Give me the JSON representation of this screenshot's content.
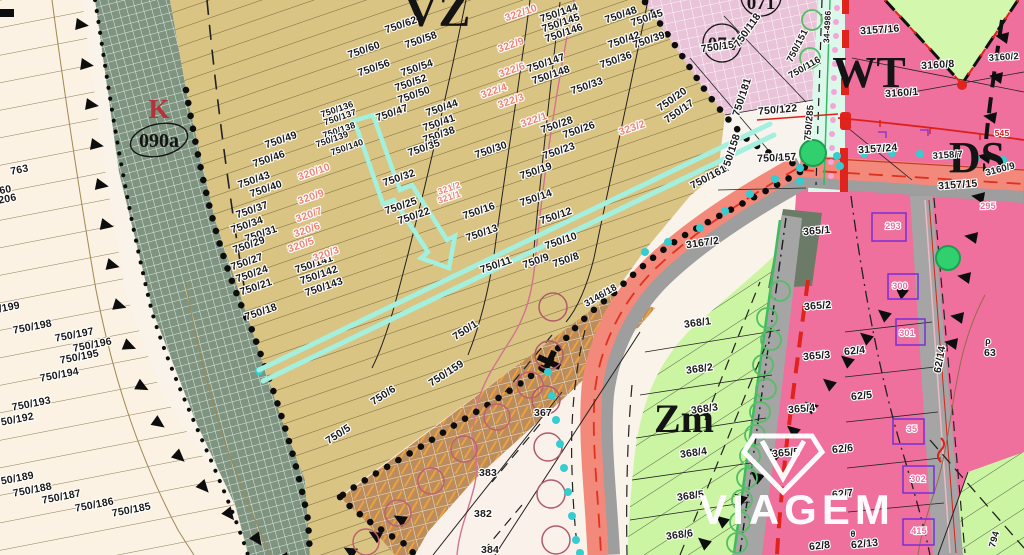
{
  "watermark": {
    "brand": "VIAGEM"
  },
  "zone_labels": {
    "vz": {
      "text": "VZ"
    },
    "k": {
      "text": "K"
    },
    "k_code": {
      "text": "090a"
    },
    "z074": {
      "text": "074"
    },
    "z071": {
      "text": "071"
    },
    "wt": {
      "text": "WT"
    },
    "ds": {
      "text": "DS"
    },
    "zm": {
      "text": "Zm"
    }
  },
  "colors": {
    "route_highlight": "#a4f0de",
    "road_salmon": "#f2897b",
    "road_gray": "#a5a5a5",
    "zone_tan": "#d9c483",
    "zone_green_band": "#7e9480",
    "zone_pink_grid": "#e9c3d8",
    "zone_pink": "#ef6f9d",
    "zone_zm_green": "#ccf5a3",
    "zone_cream": "#fbf2e3",
    "boundary_black": "#111111",
    "accent_red": "#dd2019",
    "teal_dots": "#35cdd0",
    "parcel_pink_text": "#ee8374",
    "building_pink_text": "#f0699c"
  },
  "parcel_labels": [
    {
      "t": "750/62",
      "x": 402,
      "y": 28,
      "r": -19
    },
    {
      "t": "750/60",
      "x": 365,
      "y": 53,
      "r": -19
    },
    {
      "t": "750/58",
      "x": 422,
      "y": 43,
      "r": -19
    },
    {
      "t": "750/56",
      "x": 375,
      "y": 71,
      "r": -19
    },
    {
      "t": "750/54",
      "x": 418,
      "y": 71,
      "r": -19
    },
    {
      "t": "750/52",
      "x": 412,
      "y": 86,
      "r": -19
    },
    {
      "t": "750/50",
      "x": 415,
      "y": 98,
      "r": -19
    },
    {
      "t": "750/47",
      "x": 393,
      "y": 116,
      "r": -19
    },
    {
      "t": "750/44",
      "x": 443,
      "y": 111,
      "r": -19
    },
    {
      "t": "750/41",
      "x": 440,
      "y": 126,
      "r": -19
    },
    {
      "t": "750/38",
      "x": 440,
      "y": 138,
      "r": -19
    },
    {
      "t": "750/35",
      "x": 425,
      "y": 151,
      "r": -19
    },
    {
      "t": "750/32",
      "x": 400,
      "y": 181,
      "r": -19
    },
    {
      "t": "750/30",
      "x": 492,
      "y": 153,
      "r": -19
    },
    {
      "t": "750/25",
      "x": 402,
      "y": 209,
      "r": -19
    },
    {
      "t": "750/22",
      "x": 415,
      "y": 219,
      "r": -19
    },
    {
      "t": "750/16",
      "x": 480,
      "y": 214,
      "r": -19
    },
    {
      "t": "750/13",
      "x": 483,
      "y": 236,
      "r": -19
    },
    {
      "t": "750/11",
      "x": 497,
      "y": 268,
      "r": -19
    },
    {
      "t": "750/19",
      "x": 537,
      "y": 174,
      "r": -19
    },
    {
      "t": "750/14",
      "x": 537,
      "y": 201,
      "r": -19
    },
    {
      "t": "750/12",
      "x": 557,
      "y": 219,
      "r": -19
    },
    {
      "t": "750/10",
      "x": 562,
      "y": 244,
      "r": -19
    },
    {
      "t": "750/9",
      "x": 537,
      "y": 264,
      "r": -19
    },
    {
      "t": "750/8",
      "x": 567,
      "y": 263,
      "r": -19
    },
    {
      "t": "750/23",
      "x": 560,
      "y": 154,
      "r": -19
    },
    {
      "t": "750/26",
      "x": 580,
      "y": 133,
      "r": -19
    },
    {
      "t": "750/28",
      "x": 558,
      "y": 128,
      "r": -19
    },
    {
      "t": "750/33",
      "x": 588,
      "y": 89,
      "r": -19
    },
    {
      "t": "750/36",
      "x": 617,
      "y": 63,
      "r": -19
    },
    {
      "t": "750/42",
      "x": 625,
      "y": 43,
      "r": -19
    },
    {
      "t": "750/48",
      "x": 622,
      "y": 18,
      "r": -19
    },
    {
      "t": "750/45",
      "x": 648,
      "y": 21,
      "r": -19
    },
    {
      "t": "750/39",
      "x": 650,
      "y": 43,
      "r": -19
    },
    {
      "t": "750/144",
      "x": 560,
      "y": 16,
      "r": -19
    },
    {
      "t": "750/145",
      "x": 562,
      "y": 26,
      "r": -19
    },
    {
      "t": "750/146",
      "x": 565,
      "y": 36,
      "r": -19
    },
    {
      "t": "750/147",
      "x": 547,
      "y": 66,
      "r": -19
    },
    {
      "t": "750/148",
      "x": 552,
      "y": 78,
      "r": -19
    },
    {
      "t": "750/20",
      "x": 674,
      "y": 102,
      "r": -35
    },
    {
      "t": "750/17",
      "x": 681,
      "y": 114,
      "r": -35
    },
    {
      "t": "750/136",
      "x": 338,
      "y": 112,
      "r": -19,
      "s": 9
    },
    {
      "t": "750/137",
      "x": 341,
      "y": 120,
      "r": -19,
      "s": 9
    },
    {
      "t": "750/138",
      "x": 340,
      "y": 133,
      "r": -19,
      "s": 9
    },
    {
      "t": "750/139",
      "x": 333,
      "y": 142,
      "r": -19,
      "s": 9
    },
    {
      "t": "750/140",
      "x": 348,
      "y": 150,
      "r": -19,
      "s": 9
    },
    {
      "t": "750/49",
      "x": 282,
      "y": 143,
      "r": -19
    },
    {
      "t": "750/46",
      "x": 270,
      "y": 162,
      "r": -19
    },
    {
      "t": "750/43",
      "x": 255,
      "y": 183,
      "r": -19
    },
    {
      "t": "750/40",
      "x": 267,
      "y": 192,
      "r": -19
    },
    {
      "t": "750/37",
      "x": 253,
      "y": 213,
      "r": -19
    },
    {
      "t": "750/34",
      "x": 248,
      "y": 228,
      "r": -19
    },
    {
      "t": "750/31",
      "x": 262,
      "y": 237,
      "r": -19
    },
    {
      "t": "750/29",
      "x": 250,
      "y": 248,
      "r": -19
    },
    {
      "t": "750/27",
      "x": 248,
      "y": 265,
      "r": -19
    },
    {
      "t": "750/24",
      "x": 253,
      "y": 277,
      "r": -19
    },
    {
      "t": "750/21",
      "x": 257,
      "y": 290,
      "r": -19
    },
    {
      "t": "750/18",
      "x": 262,
      "y": 315,
      "r": -19
    },
    {
      "t": "750/141",
      "x": 315,
      "y": 267,
      "r": -19
    },
    {
      "t": "750/142",
      "x": 320,
      "y": 278,
      "r": -19
    },
    {
      "t": "750/143",
      "x": 325,
      "y": 290,
      "r": -19
    },
    {
      "t": "322/10",
      "x": 522,
      "y": 16,
      "r": -19,
      "c": "pink"
    },
    {
      "t": "322/9",
      "x": 512,
      "y": 48,
      "r": -19,
      "c": "pink"
    },
    {
      "t": "322/6",
      "x": 513,
      "y": 73,
      "r": -19,
      "c": "pink"
    },
    {
      "t": "322/4",
      "x": 495,
      "y": 94,
      "r": -19,
      "c": "pink"
    },
    {
      "t": "322/3",
      "x": 512,
      "y": 104,
      "r": -19,
      "c": "pink"
    },
    {
      "t": "322/1",
      "x": 535,
      "y": 123,
      "r": -19,
      "c": "pink"
    },
    {
      "t": "323/2",
      "x": 633,
      "y": 131,
      "r": -19,
      "c": "pink"
    },
    {
      "t": "321/2",
      "x": 450,
      "y": 191,
      "r": -19,
      "c": "pink",
      "s": 9
    },
    {
      "t": "321/1",
      "x": 450,
      "y": 200,
      "r": -19,
      "c": "pink",
      "s": 9
    },
    {
      "t": "320/10",
      "x": 315,
      "y": 175,
      "r": -19,
      "c": "pink"
    },
    {
      "t": "320/9",
      "x": 312,
      "y": 200,
      "r": -19,
      "c": "pink"
    },
    {
      "t": "320/7",
      "x": 310,
      "y": 218,
      "r": -19,
      "c": "pink"
    },
    {
      "t": "320/6",
      "x": 308,
      "y": 233,
      "r": -19,
      "c": "pink"
    },
    {
      "t": "320/5",
      "x": 302,
      "y": 248,
      "r": -19,
      "c": "pink"
    },
    {
      "t": "320/3",
      "x": 327,
      "y": 257,
      "r": -19,
      "c": "pink"
    },
    {
      "t": "750/1",
      "x": 467,
      "y": 333,
      "r": -33
    },
    {
      "t": "750/159",
      "x": 448,
      "y": 376,
      "r": -33
    },
    {
      "t": "750/6",
      "x": 385,
      "y": 398,
      "r": -33
    },
    {
      "t": "750/5",
      "x": 340,
      "y": 437,
      "r": -33
    },
    {
      "t": "3167/2",
      "x": 703,
      "y": 246,
      "r": -8
    },
    {
      "t": "3146/18",
      "x": 602,
      "y": 298,
      "r": -30,
      "s": 9.5
    },
    {
      "t": "750/198",
      "x": 33,
      "y": 330,
      "r": -11
    },
    {
      "t": "750/197",
      "x": 75,
      "y": 338,
      "r": -11
    },
    {
      "t": "750/196",
      "x": 93,
      "y": 348,
      "r": -11
    },
    {
      "t": "750/195",
      "x": 80,
      "y": 360,
      "r": -11
    },
    {
      "t": "750/194",
      "x": 60,
      "y": 378,
      "r": -11
    },
    {
      "t": "750/193",
      "x": 32,
      "y": 407,
      "r": -11
    },
    {
      "t": "750/192",
      "x": 15,
      "y": 423,
      "r": -11
    },
    {
      "t": "750/189",
      "x": 15,
      "y": 482,
      "r": -11
    },
    {
      "t": "750/188",
      "x": 33,
      "y": 493,
      "r": -11
    },
    {
      "t": "750/187",
      "x": 62,
      "y": 500,
      "r": -11
    },
    {
      "t": "750/186",
      "x": 95,
      "y": 508,
      "r": -11
    },
    {
      "t": "750/185",
      "x": 132,
      "y": 513,
      "r": -11
    },
    {
      "t": "750/199",
      "x": 1,
      "y": 312,
      "r": -11
    },
    {
      "t": "763",
      "x": 20,
      "y": 173,
      "r": -11
    },
    {
      "t": "60",
      "x": 6,
      "y": 193,
      "r": -11
    },
    {
      "t": "206",
      "x": 8,
      "y": 202,
      "r": -11
    },
    {
      "t": "750/15",
      "x": 718,
      "y": 50,
      "r": -8
    },
    {
      "t": "750/118",
      "x": 750,
      "y": 32,
      "r": -55
    },
    {
      "t": "750/151",
      "x": 800,
      "y": 47,
      "r": -63,
      "s": 9.5
    },
    {
      "t": "750/116",
      "x": 806,
      "y": 70,
      "r": -30,
      "s": 9.5
    },
    {
      "t": "750/181",
      "x": 745,
      "y": 98,
      "r": -72
    },
    {
      "t": "750/122",
      "x": 778,
      "y": 113,
      "r": -5
    },
    {
      "t": "750/285",
      "x": 812,
      "y": 123,
      "r": -85,
      "s": 9.5
    },
    {
      "t": "750/157",
      "x": 777,
      "y": 161,
      "r": -3
    },
    {
      "t": "750/158",
      "x": 734,
      "y": 154,
      "r": -72
    },
    {
      "t": "750/161",
      "x": 710,
      "y": 180,
      "r": -28
    },
    {
      "t": "34-4986",
      "x": 830,
      "y": 27,
      "r": -87,
      "s": 8.5
    },
    {
      "t": "3157/16",
      "x": 880,
      "y": 33,
      "r": -4
    },
    {
      "t": "3160/8",
      "x": 938,
      "y": 68,
      "r": -4
    },
    {
      "t": "3160/1",
      "x": 902,
      "y": 96,
      "r": -4
    },
    {
      "t": "3157/24",
      "x": 878,
      "y": 152,
      "r": -4
    },
    {
      "t": "3158/7",
      "x": 948,
      "y": 158,
      "r": -4,
      "s": 9.5
    },
    {
      "t": "3157/15",
      "x": 958,
      "y": 188,
      "r": -4
    },
    {
      "t": "3160/9",
      "x": 1001,
      "y": 172,
      "r": -15,
      "s": 9.5
    },
    {
      "t": "3160/2",
      "x": 1004,
      "y": 60,
      "r": -4,
      "s": 9.5
    },
    {
      "t": "545",
      "x": 1002,
      "y": 136,
      "r": 0,
      "s": 8.5,
      "c": "red"
    },
    {
      "t": "62/4",
      "x": 855,
      "y": 354,
      "r": -6
    },
    {
      "t": "62/5",
      "x": 862,
      "y": 399,
      "r": -6
    },
    {
      "t": "62/6",
      "x": 843,
      "y": 452,
      "r": -6
    },
    {
      "t": "62/7",
      "x": 843,
      "y": 497,
      "r": -6
    },
    {
      "t": "62/8",
      "x": 820,
      "y": 549,
      "r": -6
    },
    {
      "t": "62/13",
      "x": 865,
      "y": 547,
      "r": -6
    },
    {
      "t": "62/14",
      "x": 943,
      "y": 360,
      "r": -80
    },
    {
      "t": "63",
      "x": 990,
      "y": 356,
      "r": 0
    },
    {
      "t": "θ",
      "x": 853,
      "y": 537,
      "r": 0,
      "s": 9
    },
    {
      "t": "ρ",
      "x": 988,
      "y": 344,
      "r": 0,
      "s": 9
    },
    {
      "t": "295",
      "x": 988,
      "y": 209,
      "r": 0,
      "s": 9,
      "c": "bpink"
    },
    {
      "t": "293",
      "x": 893,
      "y": 229,
      "r": 0,
      "s": 9,
      "c": "bpink"
    },
    {
      "t": "300",
      "x": 900,
      "y": 289,
      "r": 0,
      "s": 9,
      "c": "bpink"
    },
    {
      "t": "301",
      "x": 907,
      "y": 336,
      "r": 0,
      "s": 9,
      "c": "bpink"
    },
    {
      "t": "302",
      "x": 918,
      "y": 482,
      "r": 0,
      "s": 9,
      "c": "bpink"
    },
    {
      "t": "415",
      "x": 919,
      "y": 534,
      "r": 0,
      "s": 9,
      "c": "bpink"
    },
    {
      "t": "35",
      "x": 912,
      "y": 432,
      "r": 0,
      "s": 9,
      "c": "bpink"
    },
    {
      "t": "365/1",
      "x": 817,
      "y": 234,
      "r": -5
    },
    {
      "t": "365/2",
      "x": 818,
      "y": 309,
      "r": -5
    },
    {
      "t": "365/3",
      "x": 817,
      "y": 359,
      "r": -5
    },
    {
      "t": "365/4",
      "x": 802,
      "y": 412,
      "r": -5
    },
    {
      "t": "365/5",
      "x": 786,
      "y": 456,
      "r": -5
    },
    {
      "t": "368/1",
      "x": 698,
      "y": 326,
      "r": -8
    },
    {
      "t": "368/2",
      "x": 700,
      "y": 372,
      "r": -8
    },
    {
      "t": "368/3",
      "x": 705,
      "y": 412,
      "r": -8
    },
    {
      "t": "368/4",
      "x": 694,
      "y": 456,
      "r": -8
    },
    {
      "t": "368/5",
      "x": 691,
      "y": 499,
      "r": -8
    },
    {
      "t": "368/6",
      "x": 680,
      "y": 538,
      "r": -8
    },
    {
      "t": "794",
      "x": 997,
      "y": 540,
      "r": -75,
      "s": 9.5
    },
    {
      "t": "367",
      "x": 543,
      "y": 416,
      "r": 0
    },
    {
      "t": "383",
      "x": 488,
      "y": 476,
      "r": 0
    },
    {
      "t": "382",
      "x": 483,
      "y": 517,
      "r": 0
    },
    {
      "t": "384",
      "x": 490,
      "y": 553,
      "r": 0
    }
  ]
}
